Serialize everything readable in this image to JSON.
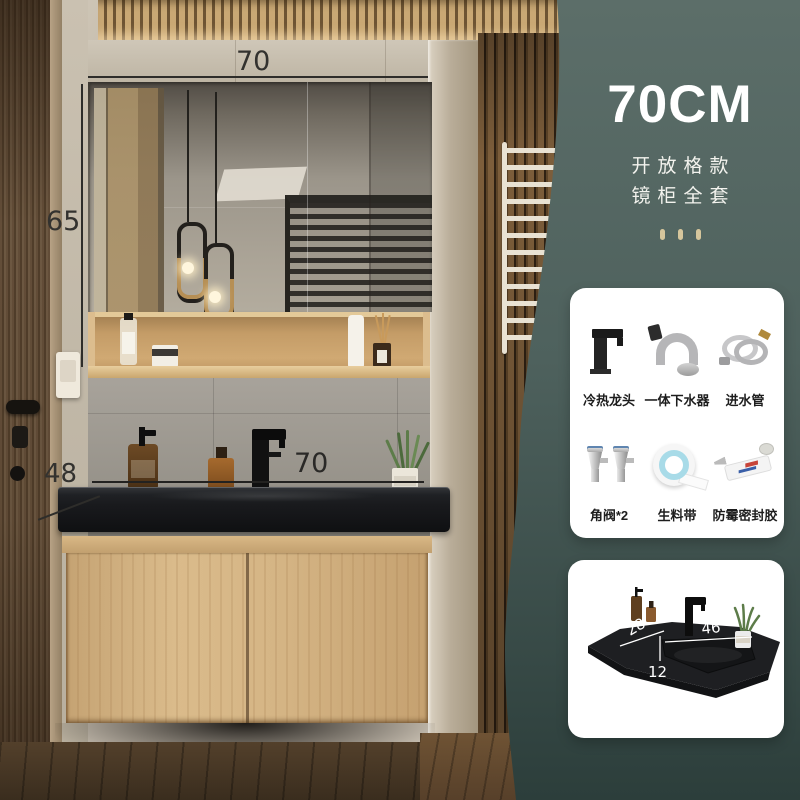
{
  "panel": {
    "size_label": "70CM",
    "subtitle_line1": "开放格款",
    "subtitle_line2": "镜柜全套"
  },
  "dimensions": {
    "cabinet_width": "70",
    "mirror_height": "65",
    "counter_depth": "48",
    "counter_width": "70"
  },
  "sink_card": {
    "depth": "28",
    "basin_width": "46",
    "basin_height": "12"
  },
  "accessories": {
    "items": [
      {
        "label": "冷热龙头",
        "icon": "faucet-icon"
      },
      {
        "label": "一体下水器",
        "icon": "drain-pipe-icon"
      },
      {
        "label": "进水管",
        "icon": "inlet-hose-icon"
      },
      {
        "label": "角阀*2",
        "icon": "angle-valve-icon"
      },
      {
        "label": "生料带",
        "icon": "thread-seal-tape-icon"
      },
      {
        "label": "防霉密封胶",
        "icon": "sealant-tube-icon"
      }
    ]
  },
  "colors": {
    "panel_top": "#5c6e69",
    "panel_bottom": "#2c3e3b",
    "accent_dots": "#d6c69c",
    "counter_black": "#1c1d1f",
    "cabinet_oak": "#cfae7d"
  }
}
